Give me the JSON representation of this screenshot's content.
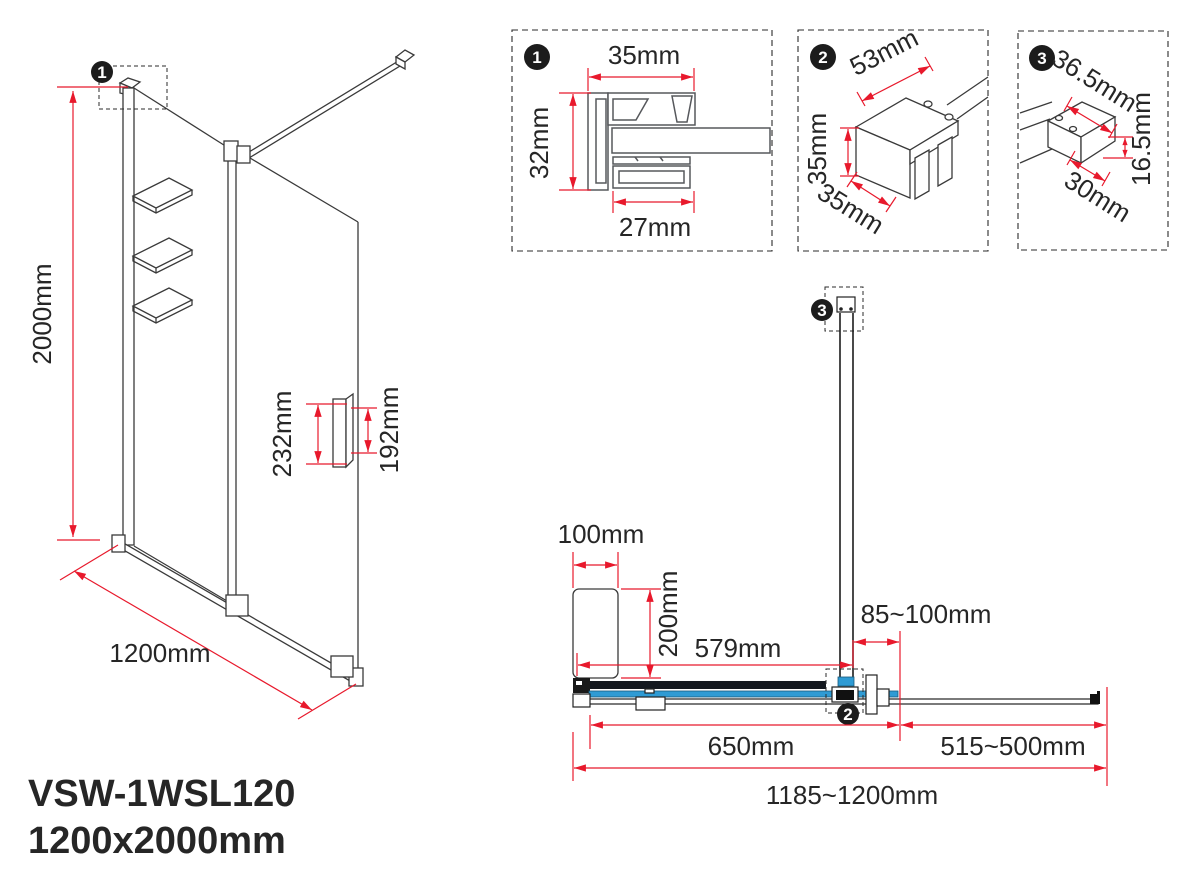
{
  "title": {
    "model": "VSW-1WSL120",
    "size": "1200x2000mm"
  },
  "colors": {
    "red": "#e8192c",
    "blue": "#2f9bd4",
    "ink": "#262626"
  },
  "iso": {
    "marker": "1",
    "height": "2000mm",
    "width": "1200mm",
    "handle_length": "232mm",
    "handle_centers": "192mm"
  },
  "detail1": {
    "marker": "1",
    "top_width": "35mm",
    "side_height": "32mm",
    "bottom_width": "27mm"
  },
  "detail2": {
    "marker": "2",
    "top_width": "53mm",
    "side_height": "35mm",
    "depth": "35mm"
  },
  "detail3": {
    "marker": "3",
    "top_width": "36.5mm",
    "side_height": "16.5mm",
    "bottom_width": "30mm"
  },
  "plan": {
    "wall_bracket_marker": "3",
    "clamp_marker": "2",
    "offset_width": "100mm",
    "offset_depth": "200mm",
    "bar_offset": "579mm",
    "bar_wall_gap": "85~100mm",
    "fixed_panel": "650mm",
    "adjustable_panel": "515~500mm",
    "total_width": "1185~1200mm"
  }
}
